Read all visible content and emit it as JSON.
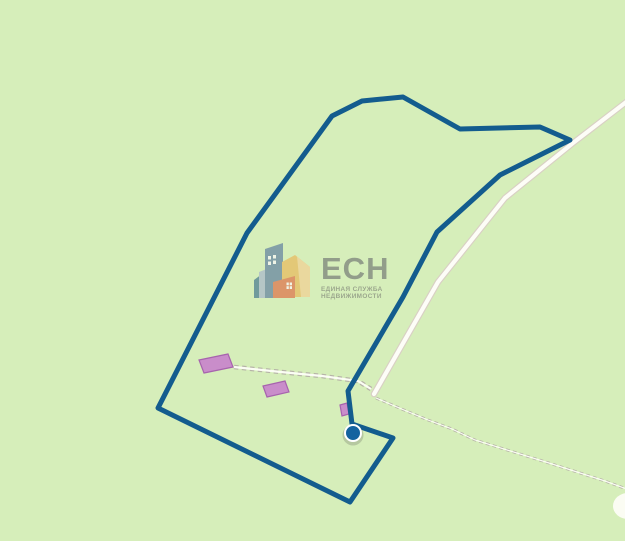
{
  "map": {
    "background_color": "#d6eeba",
    "plot": {
      "points": "403,97 460,129 540,127 570,140 500,175 437,232 403,297 348,391 352,424 393,438 350,502 158,408 247,233 332,116 362,101",
      "stroke_color": "#135c8e"
    },
    "marker": {
      "cx": 353,
      "cy": 433,
      "r": 8,
      "fill": "#15639f",
      "ring_color": "#ffffff",
      "shadow_color": "rgba(70,70,70,0.22)"
    },
    "road": {
      "d": "M 634,96 L 573,143 L 505,198 L 438,282 L 374,394",
      "core_color": "#fdfdf7",
      "casing_color": "#d9d0c4"
    },
    "tracks": {
      "color": "#b6b4a7",
      "left_d": "M 234,367 L 281,372 L 322,376 L 358,381 L 371,389",
      "right_d": "M 376,398 L 404,410 L 428,420 L 452,429 L 475,440 L 549,463 L 605,481 L 632,491"
    },
    "buildings": {
      "fill": "#c98dca",
      "stroke": "#a763ae",
      "footprints": [
        "199,360 228,354 233,367 204,373",
        "263,386 285,381 289,392 267,397",
        "340,405 347,403 349,414 342,416"
      ]
    },
    "clearing": {
      "cx": 628,
      "cy": 506,
      "rx": 15,
      "ry": 13,
      "fill": "#fbfcf3"
    }
  },
  "watermark": {
    "title": "ЕСН",
    "subtitle_line1": "ЕДИНАЯ СЛУЖБА",
    "subtitle_line2": "НЕДВИЖИМОСТИ",
    "text_color": "#8d9787",
    "colors": {
      "teal": "#68949a",
      "slate_light": "#b3c3c8",
      "slate": "#7d9aa6",
      "yellow": "#e5c572",
      "yellow_light": "#ecd79c",
      "orange": "#dd8e63",
      "window": "#f2f5ea"
    }
  }
}
